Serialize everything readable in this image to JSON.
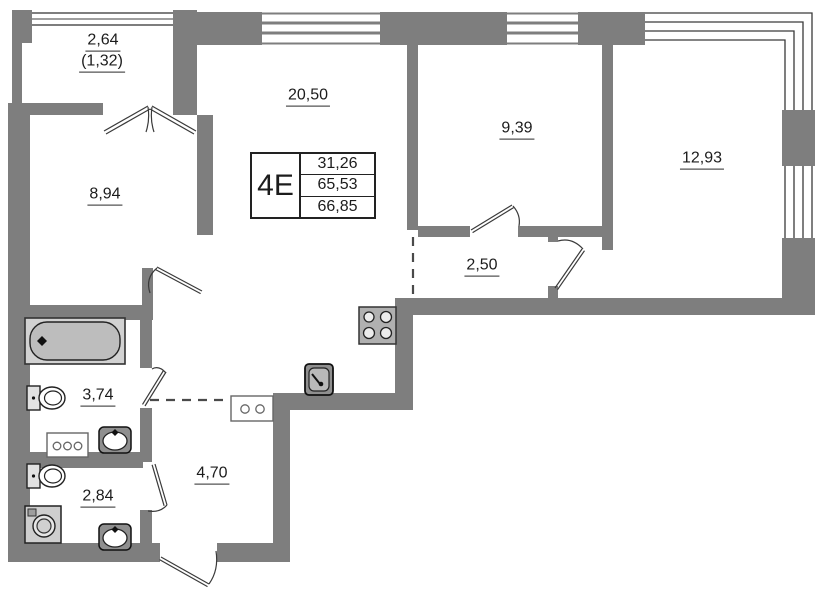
{
  "unit": {
    "label": "4E",
    "area_living": "31,26",
    "area_heated": "65,53",
    "area_total": "66,85"
  },
  "rooms": {
    "balcony": {
      "area": "2,64",
      "area_reduced": "(1,32)"
    },
    "room_left": {
      "area": "8,94"
    },
    "living": {
      "area": "20,50"
    },
    "room_mid": {
      "area": "9,39"
    },
    "room_right": {
      "area": "12,93"
    },
    "corridor": {
      "area": "2,50"
    },
    "bathroom": {
      "area": "3,74"
    },
    "hallway": {
      "area": "4,70"
    },
    "wc": {
      "area": "2,84"
    }
  },
  "colors": {
    "wall": "#7e7e7e",
    "line": "#3a3a3a",
    "fixture_fill": "#bdbdbd",
    "text": "#1c1c1c"
  }
}
